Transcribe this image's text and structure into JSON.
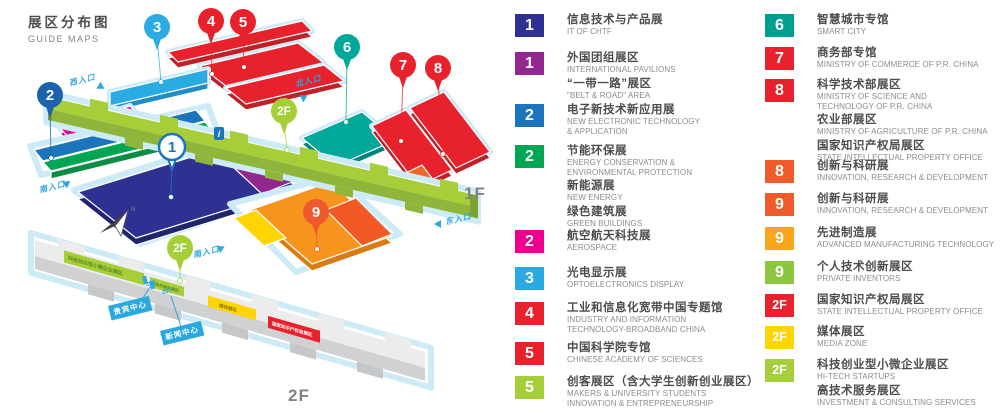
{
  "title": {
    "zh": "展区分布图",
    "en": "GUIDE MAPS"
  },
  "floor_labels": [
    {
      "text": "1F",
      "x": 464,
      "y": 184
    },
    {
      "text": "2F",
      "x": 288,
      "y": 386
    }
  ],
  "map": {
    "pins": [
      {
        "label": "2",
        "color": "#1b63ad",
        "x": 50,
        "y": 95,
        "tx": 51,
        "ty": 158,
        "style": "solid"
      },
      {
        "label": "3",
        "color": "#2aabe4",
        "x": 157,
        "y": 27,
        "tx": 161,
        "ty": 82,
        "style": "solid"
      },
      {
        "label": "4",
        "color": "#e8222d",
        "x": 211,
        "y": 21,
        "tx": 212,
        "ty": 74,
        "style": "solid"
      },
      {
        "label": "5",
        "color": "#e8222d",
        "x": 243,
        "y": 22,
        "tx": 244,
        "ty": 67,
        "style": "solid"
      },
      {
        "label": "6",
        "color": "#00a79b",
        "x": 347,
        "y": 47,
        "tx": 346,
        "ty": 122,
        "style": "solid"
      },
      {
        "label": "7",
        "color": "#e8222d",
        "x": 403,
        "y": 65,
        "tx": 401,
        "ty": 141,
        "style": "solid"
      },
      {
        "label": "8",
        "color": "#e8222d",
        "x": 438,
        "y": 68,
        "tx": 443,
        "ty": 154,
        "style": "solid"
      },
      {
        "label": "2F",
        "color": "#a6ce39",
        "x": 284,
        "y": 111,
        "tx": 287,
        "ty": 150,
        "style": "solid"
      },
      {
        "label": "1",
        "color": "#1c75bc",
        "x": 172,
        "y": 147,
        "tx": 171,
        "ty": 197,
        "style": "outline"
      },
      {
        "label": "9",
        "color": "#f0592b",
        "x": 316,
        "y": 212,
        "tx": 317,
        "ty": 249,
        "style": "solid"
      },
      {
        "label": "2F",
        "color": "#a6ce39",
        "x": 180,
        "y": 248,
        "tx": 180,
        "ty": 281,
        "style": "solid"
      }
    ],
    "entrances": [
      {
        "label": "西入口",
        "x": 68,
        "y": 78,
        "rot": -14,
        "ax": 98,
        "ay": 83,
        "arot": 30
      },
      {
        "label": "北入口",
        "x": 294,
        "y": 79,
        "rot": -14,
        "ax": 299,
        "ay": 93,
        "arot": 210
      },
      {
        "label": "南入口",
        "x": 38,
        "y": 185,
        "rot": -14,
        "ax": 64,
        "ay": 179,
        "arot": -35
      },
      {
        "label": "南入口",
        "x": 192,
        "y": 250,
        "rot": -14,
        "ax": 218,
        "ay": 244,
        "arot": -25
      },
      {
        "label": "东入口",
        "x": 444,
        "y": 217,
        "rot": -14,
        "ax": 434,
        "ay": 220,
        "arot": 180
      }
    ],
    "facilities": [
      {
        "label": "贵宾中心",
        "x": 108,
        "y": 306
      },
      {
        "label": "新闻中心",
        "x": 160,
        "y": 331
      }
    ],
    "rooms": [
      {
        "label": "206",
        "x": 146,
        "y": 281
      },
      {
        "label": "207",
        "x": 162,
        "y": 289
      }
    ],
    "patch_labels": [
      {
        "text": "科技创业型小微企业展区"
      },
      {
        "text": "高技术服务展区"
      },
      {
        "text": "媒体展区"
      },
      {
        "text": "国家知识产权局展区"
      }
    ],
    "info_icon": "i",
    "compass_n": "N"
  },
  "legend": {
    "left": [
      {
        "num": "1",
        "color": "#2e3192",
        "top": 14,
        "entries": [
          {
            "zh": "信息技术与产品展",
            "en": "IT OF CHTF"
          }
        ]
      },
      {
        "num": "1",
        "color": "#92278f",
        "top": 52,
        "entries": [
          {
            "zh": "外国团组展区",
            "en": "INTERNATIONAL PAVILIONS"
          },
          {
            "zh": "“一带一路”展区",
            "en": "\"BELT & ROAD\" AREA"
          }
        ]
      },
      {
        "num": "2",
        "color": "#1c75bc",
        "top": 104,
        "entries": [
          {
            "zh": "电子新技术新应用展",
            "en": "NEW ELECTRONIC TECHNOLOGY\n& APPLICATION"
          }
        ]
      },
      {
        "num": "2",
        "color": "#00a651",
        "top": 145,
        "entries": [
          {
            "zh": "节能环保展",
            "en": "ENERGY CONSERVATION &\nENVIRONMENTAL PROTECTION"
          },
          {
            "zh": "新能源展",
            "en": "NEW ENERGY"
          },
          {
            "zh": "绿色建筑展",
            "en": "GREEN BUILDINGS"
          }
        ]
      },
      {
        "num": "2",
        "color": "#ec008c",
        "top": 230,
        "entries": [
          {
            "zh": "航空航天科技展",
            "en": "AEROSPACE"
          }
        ]
      },
      {
        "num": "3",
        "color": "#29abe2",
        "top": 267,
        "entries": [
          {
            "zh": "光电显示展",
            "en": "OPTOELECTRONICS DISPLAY"
          }
        ]
      },
      {
        "num": "4",
        "color": "#e8222d",
        "top": 302,
        "entries": [
          {
            "zh": "工业和信息化宽带中国专题馆",
            "en": "INDUSTRY AND INFORMATION\nTECHNOLOGY-BROADBAND CHINA"
          }
        ]
      },
      {
        "num": "5",
        "color": "#e8222d",
        "top": 342,
        "entries": [
          {
            "zh": "中国科学院专馆",
            "en": "CHINESE ACADEMY OF SCIENCES"
          }
        ]
      },
      {
        "num": "5",
        "color": "#a6ce39",
        "top": 376,
        "entries": [
          {
            "zh": "创客展区（含大学生创新创业展区）",
            "en": "MAKERS & UNIVERSITY STUDENTS\nINNOVATION & ENTREPRENEURSHIP"
          }
        ]
      }
    ],
    "right": [
      {
        "num": "6",
        "color": "#009e8e",
        "top": 14,
        "entries": [
          {
            "zh": "智慧城市专馆",
            "en": "SMART CITY"
          }
        ]
      },
      {
        "num": "7",
        "color": "#e8222d",
        "top": 47,
        "entries": [
          {
            "zh": "商务部专馆",
            "en": "MINISTRY OF COMMERCE OF P.R. CHINA"
          }
        ]
      },
      {
        "num": "8",
        "color": "#e8222d",
        "top": 79,
        "entries": [
          {
            "zh": "科学技术部展区",
            "en": "MINISTRY OF SCIENCE AND\nTECHNOLOGY OF P.R. CHINA"
          },
          {
            "zh": "农业部展区",
            "en": "MINISTRY OF AGRICULTURE OF P.R. CHINA"
          },
          {
            "zh": "国家知识产权局展区",
            "en": "STATE INTELLECTUAL PROPERTY OFFICE"
          }
        ]
      },
      {
        "num": "8",
        "color": "#f15a29",
        "top": 160,
        "entries": [
          {
            "zh": "创新与科研展",
            "en": "INNOVATION, RESEARCH & DEVELOPMENT"
          }
        ]
      },
      {
        "num": "9",
        "color": "#f15a29",
        "top": 193,
        "entries": [
          {
            "zh": "创新与科研展",
            "en": "INNOVATION, RESEARCH & DEVELOPMENT"
          }
        ]
      },
      {
        "num": "9",
        "color": "#f9a61a",
        "top": 227,
        "entries": [
          {
            "zh": "先进制造展",
            "en": "ADVANCED MANUFACTURING TECHNOLOGY"
          }
        ]
      },
      {
        "num": "9",
        "color": "#8cc63f",
        "top": 261,
        "entries": [
          {
            "zh": "个人技术创新展区",
            "en": "PRIVATE INVENTORS"
          }
        ]
      },
      {
        "num": "2F",
        "color": "#e8222d",
        "top": 294,
        "entries": [
          {
            "zh": "国家知识产权局展区",
            "en": "STATE INTELLECTUAL PROPERTY OFFICE"
          }
        ]
      },
      {
        "num": "2F",
        "color": "#ffd400",
        "top": 326,
        "entries": [
          {
            "zh": "媒体展区",
            "en": "MEDIA ZONE"
          }
        ]
      },
      {
        "num": "2F",
        "color": "#a6ce39",
        "top": 359,
        "entries": [
          {
            "zh": "科技创业型小微企业展区",
            "en": "HI-TECH STARTUPS"
          },
          {
            "zh": "高技术服务展区",
            "en": "INVESTMENT & CONSULTING SERVICES"
          }
        ]
      }
    ]
  }
}
